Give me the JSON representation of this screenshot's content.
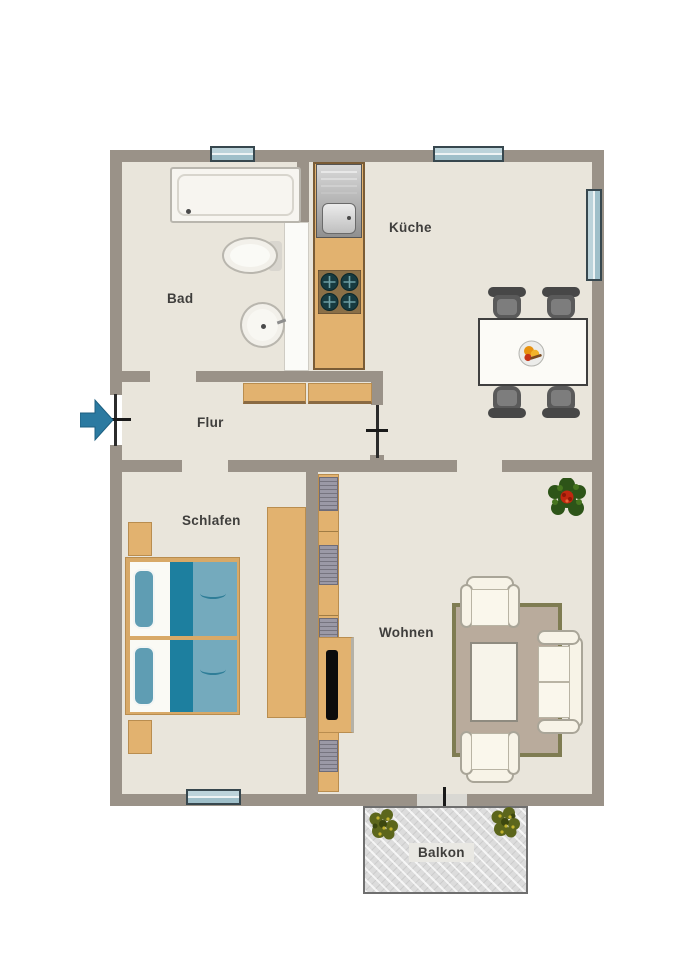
{
  "diagram": {
    "type": "apartment-floor-plan",
    "language": "de"
  },
  "rooms": {
    "bad": {
      "label": "Bad",
      "fixtures": [
        "bathtub",
        "toilet",
        "washbasin"
      ]
    },
    "kueche": {
      "label": "Küche",
      "fixtures": [
        "kitchen-sink",
        "stove-4-burners",
        "counter",
        "dining-table",
        "four-chairs",
        "fruit-bowl"
      ]
    },
    "flur": {
      "label": "Flur",
      "fixtures": [
        "sideboard",
        "entrance-door",
        "interior-door"
      ]
    },
    "schlafen": {
      "label": "Schlafen",
      "fixtures": [
        "double-bed",
        "two-nightstands",
        "wardrobe"
      ]
    },
    "wohnen": {
      "label": "Wohnen",
      "fixtures": [
        "wall-shelf",
        "tv-sideboard",
        "rug",
        "coffee-table",
        "two-armchairs",
        "sofa",
        "plant"
      ]
    },
    "balkon": {
      "label": "Balkon",
      "fixtures": [
        "two-plants"
      ]
    }
  },
  "openings": {
    "windows_count": 4,
    "entrance": "left wall with blue arrow",
    "balcony_door": "bottom wall of living room"
  },
  "colors": {
    "wall": "#9a9288",
    "floor": "#e9e5db",
    "furniture_wood": "#e2b26f",
    "wood_border": "#8a6a42",
    "bed_blanket": "#74aabd",
    "bed_fold": "#1d7f9f",
    "bed_pillow": "#5f9db3",
    "window_glass": "#bcd3da",
    "window_frame": "#37474e",
    "entrance_arrow": "#2b7aa1",
    "rug": "#b9ab9c",
    "rug_border": "#7f7c52",
    "upholstery": "#f7f3e7",
    "chair_gray": "#5a5a5a",
    "balcony_floor": "#dcdcdc",
    "plant_green": "#2d5418",
    "flower_red": "#c0270f"
  }
}
